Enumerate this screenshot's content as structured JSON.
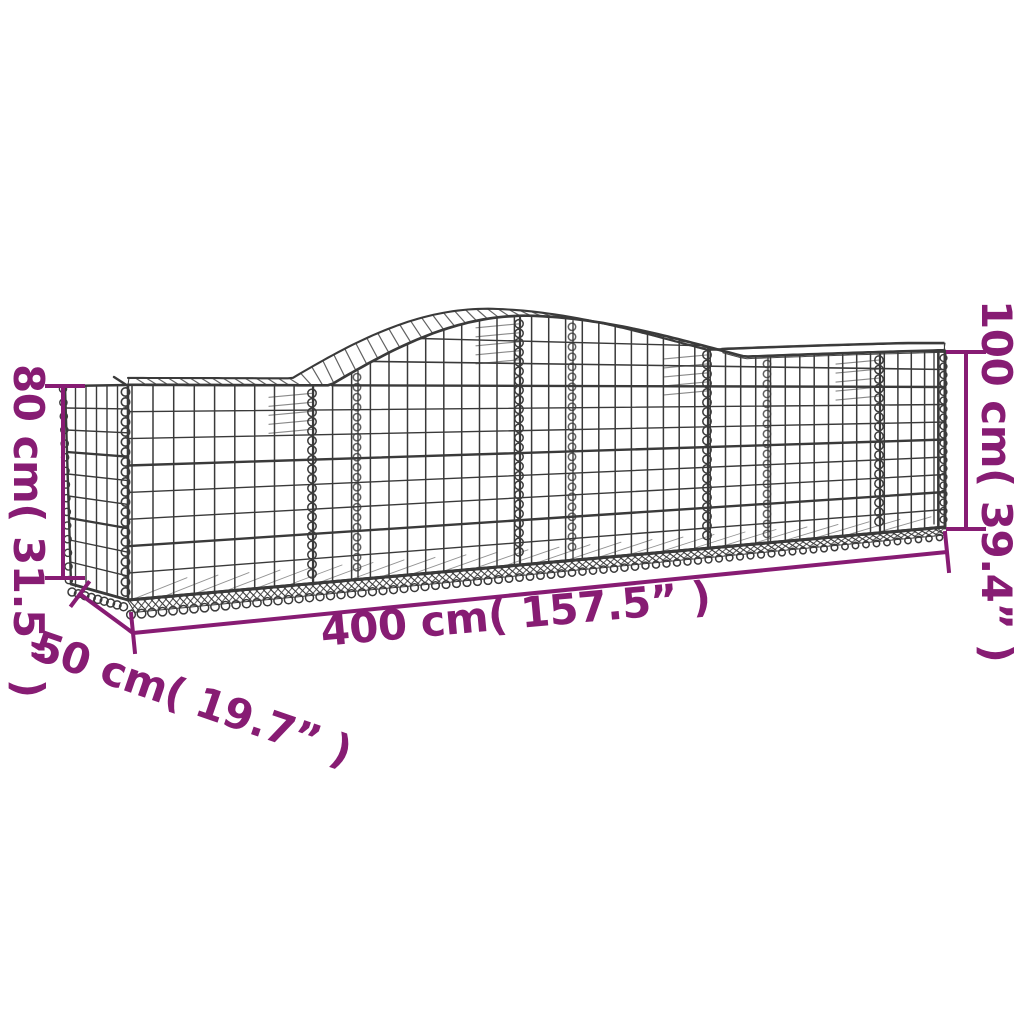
{
  "title": "Arched gabion basket dimension diagram",
  "annotations": {
    "height_left": "80 cm( 31.5” )",
    "height_right": "100 cm( 39.4” )",
    "length": "400 cm( 157.5” )",
    "depth": "50 cm( 19.7” )"
  },
  "colors": {
    "annotation_purple": "#871C73",
    "wire_gray": "#3A3A3A",
    "background": "#FFFFFF"
  }
}
